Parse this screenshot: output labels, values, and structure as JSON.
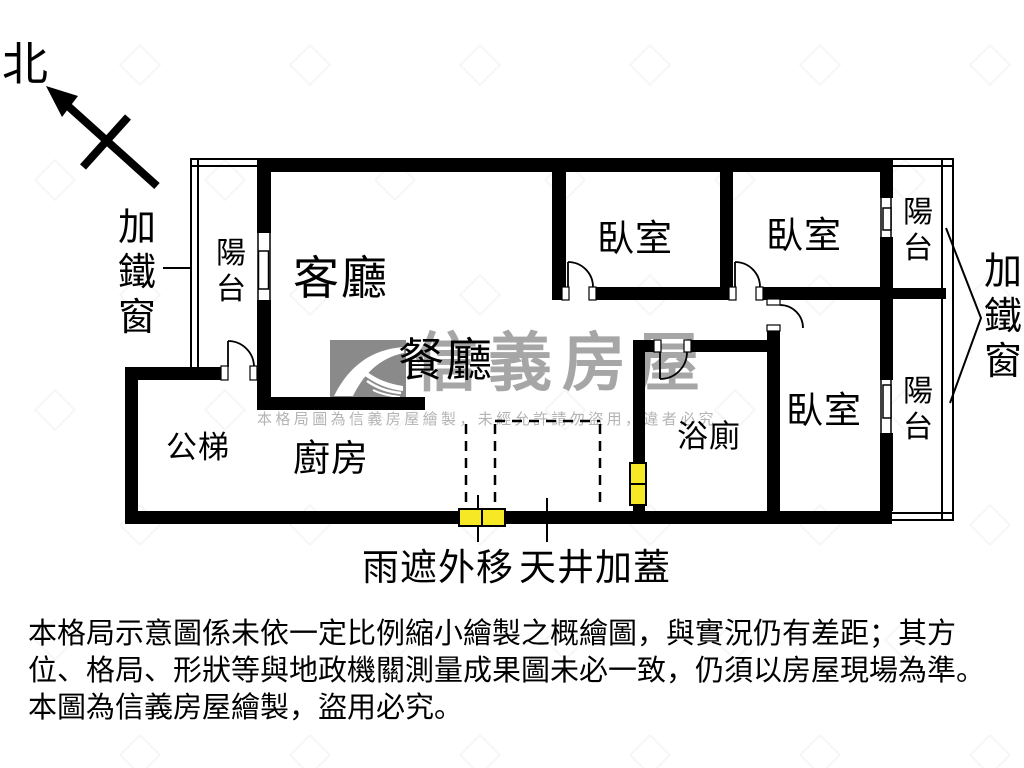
{
  "compass": {
    "label": "北"
  },
  "iron_window": {
    "left_label": "加鐵窗",
    "right_label": "加鐵窗"
  },
  "rooms": {
    "living": "客廳",
    "dining": "餐廳",
    "kitchen": "廚房",
    "bathroom": "浴廁",
    "public_stairs": "公梯",
    "bedroom1": "臥室",
    "bedroom2": "臥室",
    "bedroom3": "臥室",
    "balcony_left": "陽台",
    "balcony_top_right": "陽台",
    "balcony_bottom_right": "陽台"
  },
  "annotations": {
    "rain_shade": "雨遮外移",
    "skylight": "天井加蓋"
  },
  "watermark": {
    "brand": "信義房屋",
    "notice": "本格局圖為信義房屋繪製，未經允許請勿盜用，違者必究"
  },
  "disclaimer": {
    "line1": "本格局示意圖係未依一定比例縮小繪製之概繪圖，與實況仍有差距；其方",
    "line2": "位、格局、形狀等與地政機關測量成果圖未必一致，仍須以房屋現場為準。",
    "line3": "本圖為信義房屋繪製，盜用必究。"
  },
  "colors": {
    "wall": "#000000",
    "highlight_window": "#f6e824",
    "watermark_gray": "#a6a6a6",
    "logo_gray": "#8a8a8a"
  }
}
